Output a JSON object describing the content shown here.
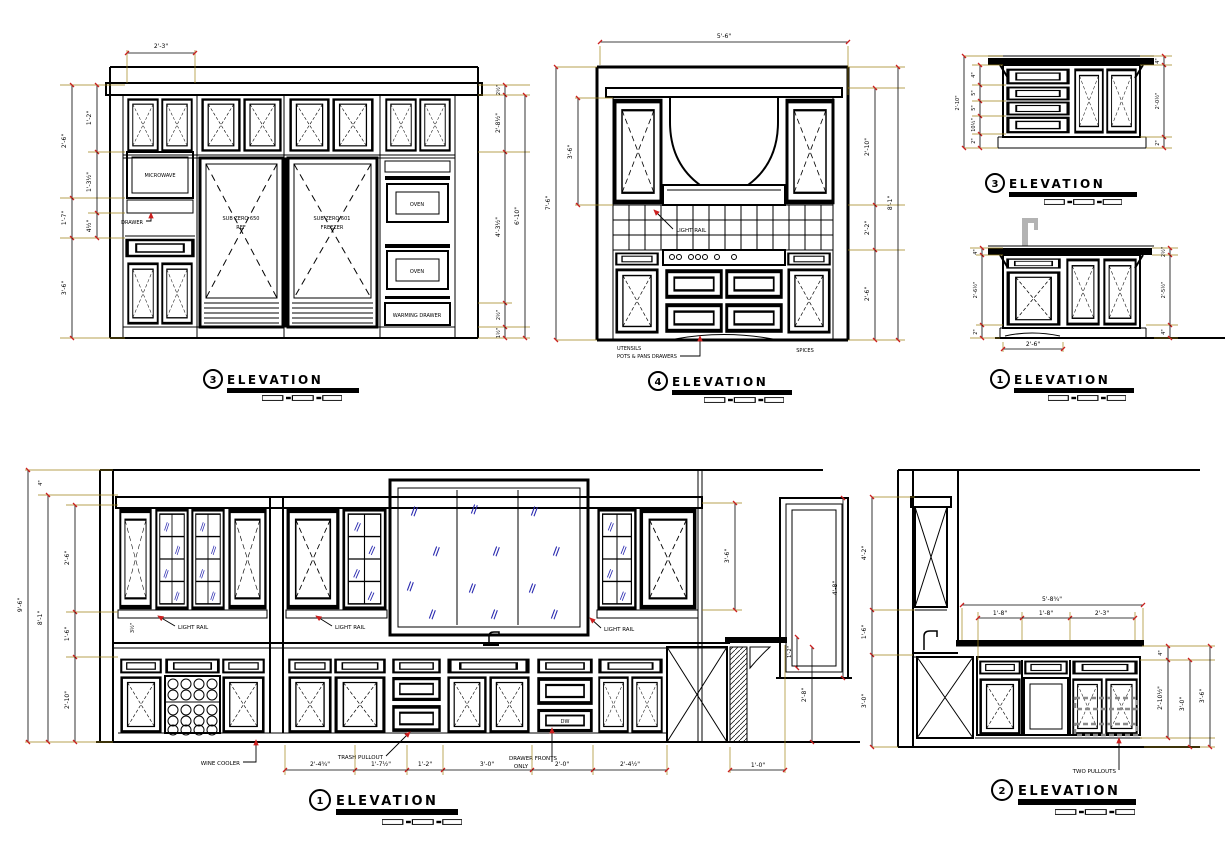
{
  "page": {
    "background": "#ffffff",
    "line_color": "#000000",
    "tick_color": "#cc1f1f",
    "extension_color": "#a08418",
    "glass_color": "#2a2ab0",
    "faucet_color": "#b3b3b3"
  },
  "e3main": {
    "num": "3",
    "title": "ELEVATION",
    "labels": {
      "microwave": "MICROWAVE",
      "drawer": "DRAWER",
      "ref1": "SUB ZERO 650",
      "ref2": "REF",
      "frz1": "SUB ZERO 601",
      "frz2": "FREEZER",
      "oven1": "OVEN",
      "oven2": "OVEN",
      "warming": "WARMING DRAWER"
    },
    "dims": {
      "top": "2'-3\"",
      "left_outer": [
        "2'-6\"",
        "1'-7\"",
        "3'-6\""
      ],
      "left_inner": [
        "1'-2\"",
        "1'-3½\"",
        "4½\""
      ],
      "right_chain": [
        "2½\"",
        "2'-8½\"",
        "4'-3½\"",
        "2½\"",
        "1½\""
      ],
      "right_outer": "6'-10\""
    }
  },
  "e4": {
    "num": "4",
    "title": "ELEVATION",
    "labels": {
      "light_rail": "LIGHT RAIL",
      "utensils": "UTENSILS",
      "pots": "POTS & PANS DRAWERS",
      "spices": "SPICES"
    },
    "dims": {
      "top": "5'-6\"",
      "left_inner": "3'-6\"",
      "left_outer": "7'-6\"",
      "right_chain": [
        "2'-10\"",
        "2'-2\"",
        "2'-6\""
      ],
      "right_outer": "8'-1\""
    }
  },
  "e3small": {
    "num": "3",
    "title": "ELEVATION",
    "dims": {
      "left_outer": "2'-10\"",
      "left_chain": [
        "4\"",
        "5\"",
        "5\"",
        "10½\"",
        "2\""
      ],
      "right_chain": [
        "4\"",
        "2'-0½\"",
        "2\""
      ]
    }
  },
  "e1small": {
    "num": "1",
    "title": "ELEVATION",
    "dims": {
      "bottom": "2'-6\"",
      "left_chain": [
        "4\"",
        "2'-6½\"",
        "2\""
      ],
      "right_chain": [
        "2½\"",
        "2'-5½\"",
        "4\""
      ]
    }
  },
  "e1main": {
    "num": "1",
    "title": "ELEVATION",
    "labels": {
      "light_rail1": "LIGHT RAIL",
      "light_rail2": "LIGHT RAIL",
      "light_rail3": "LIGHT RAIL",
      "wine_cooler": "WINE COOLER",
      "trash": "TRASH PULLOUT",
      "drawer_fronts1": "DRAWER FRONTS",
      "drawer_fronts2": "ONLY",
      "dw": "DW"
    },
    "dims": {
      "bottom": [
        "2'-4¾\"",
        "1'-7½\"",
        "1'-2\"",
        "3'-0\"",
        "2'-0\"",
        "2'-4½\""
      ],
      "bottom_right": "1'-0\"",
      "left_outer": "9'-6\"",
      "left_mid": "8'-1\"",
      "left_top": "4\"",
      "left_chain": [
        "2'-6\"",
        "1'-6\"",
        "2'-10\""
      ],
      "light_rail": "3½\"",
      "cab_height": "3'-6\"",
      "door_height": "4'-8\"",
      "bar_height": "2'-8\"",
      "bar_front": "1'-2\""
    }
  },
  "e2": {
    "num": "2",
    "title": "ELEVATION",
    "labels": {
      "two_pullouts": "TWO PULLOUTS"
    },
    "dims": {
      "top": "5'-8¾\"",
      "top_chain": [
        "1'-8\"",
        "1'-8\"",
        "2'-3\""
      ],
      "left_chain": [
        "4'-2\"",
        "1'-6\"",
        "3'-0\""
      ],
      "right_top": "4\"",
      "right_chain": [
        "2'-10½\"",
        "3'-0\"",
        "3'-6\""
      ]
    }
  }
}
